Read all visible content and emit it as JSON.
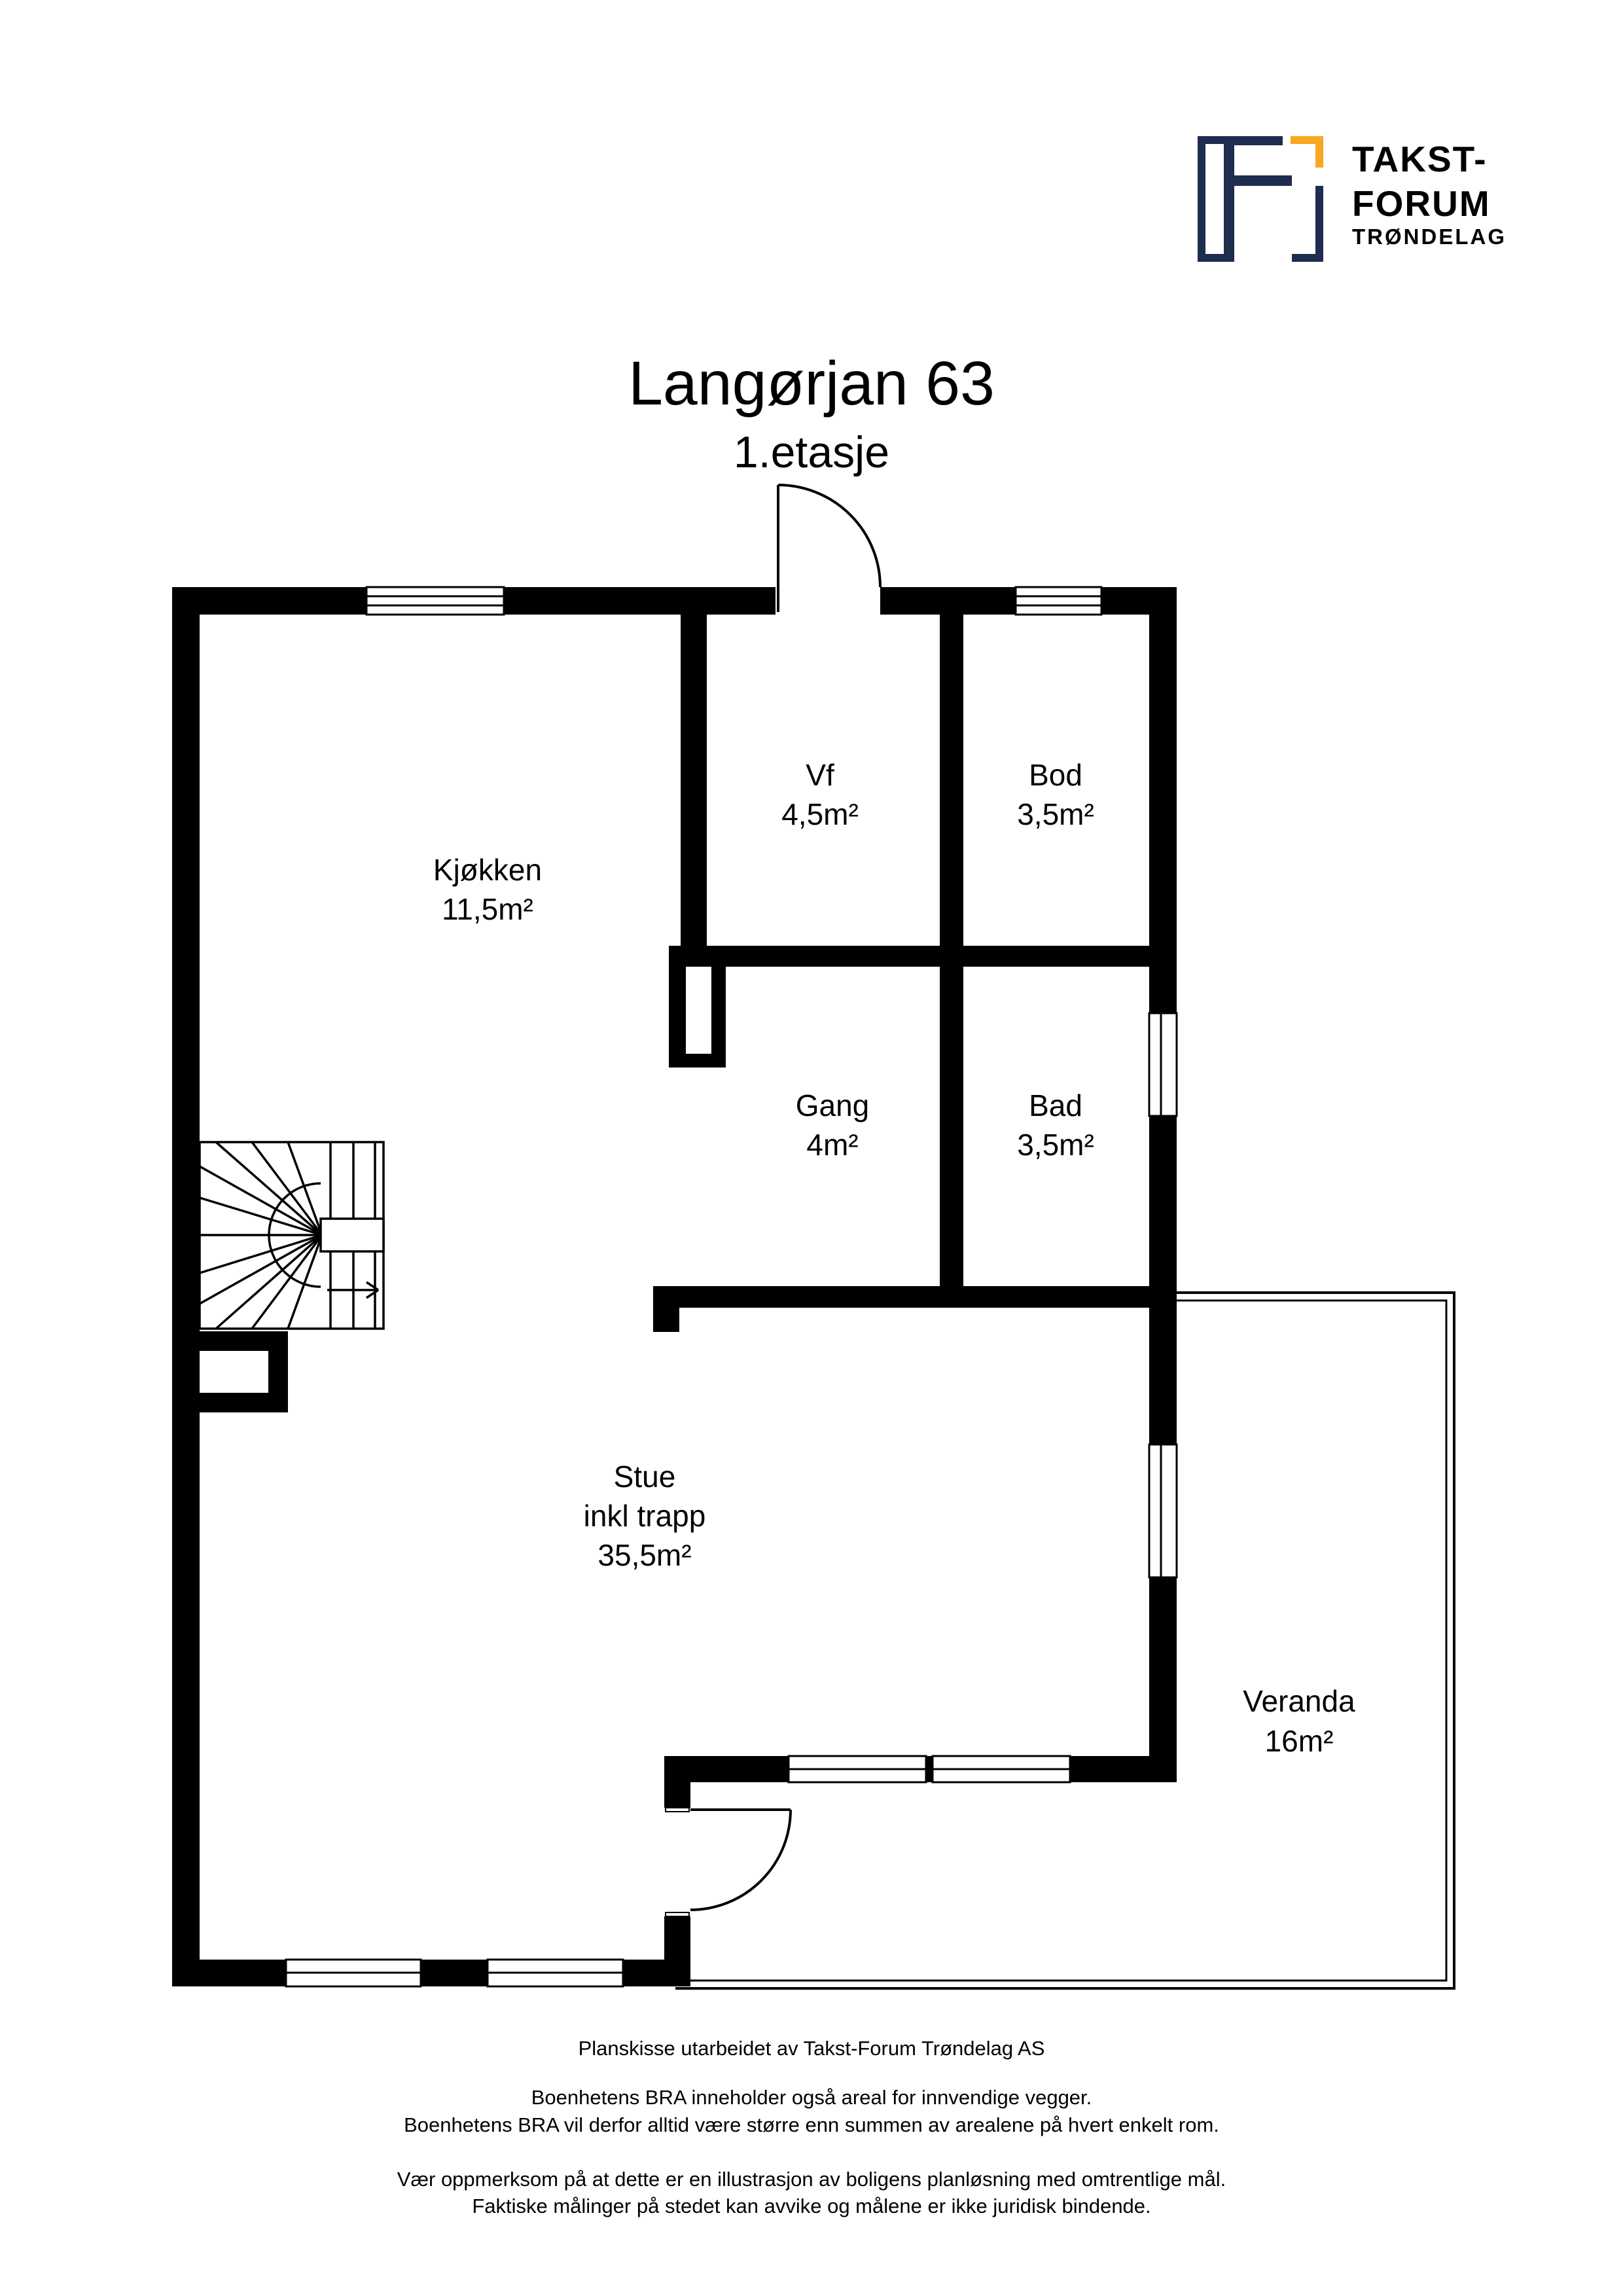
{
  "page": {
    "title": "Langørjan 63",
    "subtitle": "1.etasje"
  },
  "logo": {
    "line1": "TAKST-",
    "line2": "FORUM",
    "line3": "TRØNDELAG"
  },
  "colors": {
    "plan_line": "#000000",
    "background": "#ffffff",
    "logo_navy": "#1e2c50",
    "logo_orange": "#f6a820"
  },
  "rooms": [
    {
      "name": "Kjøkken",
      "area": "11,5m²"
    },
    {
      "name": "Vf",
      "area": "4,5m²"
    },
    {
      "name": "Bod",
      "area": "3,5m²"
    },
    {
      "name": "Gang",
      "area": "4m²"
    },
    {
      "name": "Bad",
      "area": "3,5m²"
    },
    {
      "name": "Stue",
      "name2": "inkl trapp",
      "area": "35,5m²"
    },
    {
      "name": "Veranda",
      "area": "16m²"
    }
  ],
  "footer": {
    "line1": "Planskisse utarbeidet av Takst-Forum Trøndelag AS",
    "line2": "Boenhetens BRA inneholder også areal for innvendige vegger.",
    "line3": "Boenhetens BRA vil derfor alltid være større enn summen av arealene på hvert enkelt rom.",
    "line4": "Vær oppmerksom på at dette er en illustrasjon av boligens planløsning med omtrentlige mål.",
    "line5": "Faktiske målinger på stedet kan avvike og målene er ikke juridisk bindende."
  }
}
